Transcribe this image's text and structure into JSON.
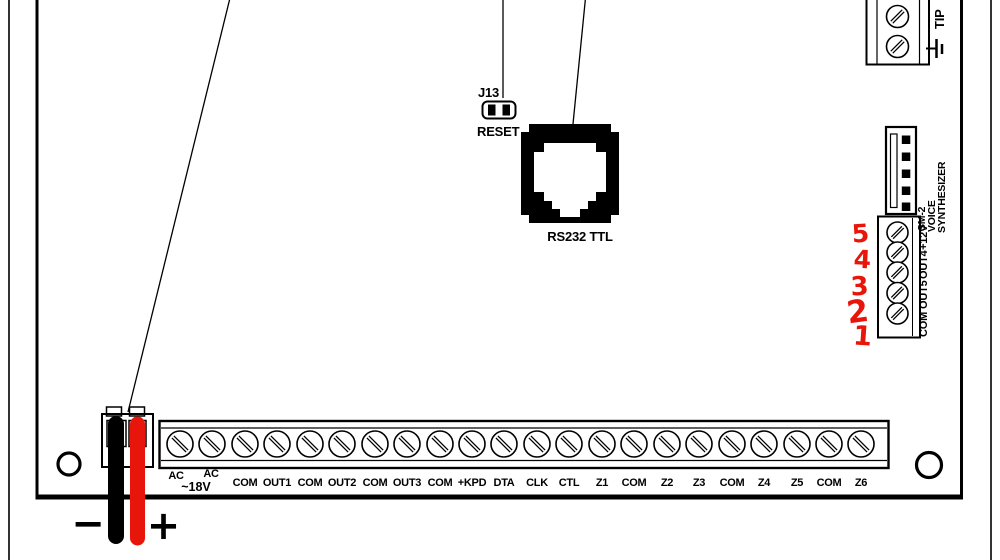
{
  "colors": {
    "wire-red": "#e8150a",
    "ink": "#000000",
    "bg": "#ffffff"
  },
  "reset_jumper": {
    "designator": "J13",
    "label": "RESET"
  },
  "serial_port": {
    "label": "RS232 TTL"
  },
  "telephone_terminals": {
    "label": "TIP"
  },
  "voice_synth": {
    "connector_name_lines": [
      "SM-2",
      "VOICE",
      "SYNTHESIZER"
    ],
    "terminal_labels": [
      "COM",
      "OUT5",
      "OUT4",
      "+12V"
    ],
    "handwritten_pins": [
      "5",
      "4",
      "3",
      "2",
      "1"
    ]
  },
  "main_terminal_strip": {
    "labels": [
      "AC",
      "AC",
      "COM",
      "OUT1",
      "COM",
      "OUT2",
      "COM",
      "OUT3",
      "COM",
      "+KPD",
      "DTA",
      "CLK",
      "CTL",
      "Z1",
      "COM",
      "Z2",
      "Z3",
      "COM",
      "Z4",
      "Z5",
      "COM",
      "Z6"
    ],
    "ac_note": "~18V"
  },
  "battery_leads": {
    "negative": "−",
    "positive": "+"
  }
}
